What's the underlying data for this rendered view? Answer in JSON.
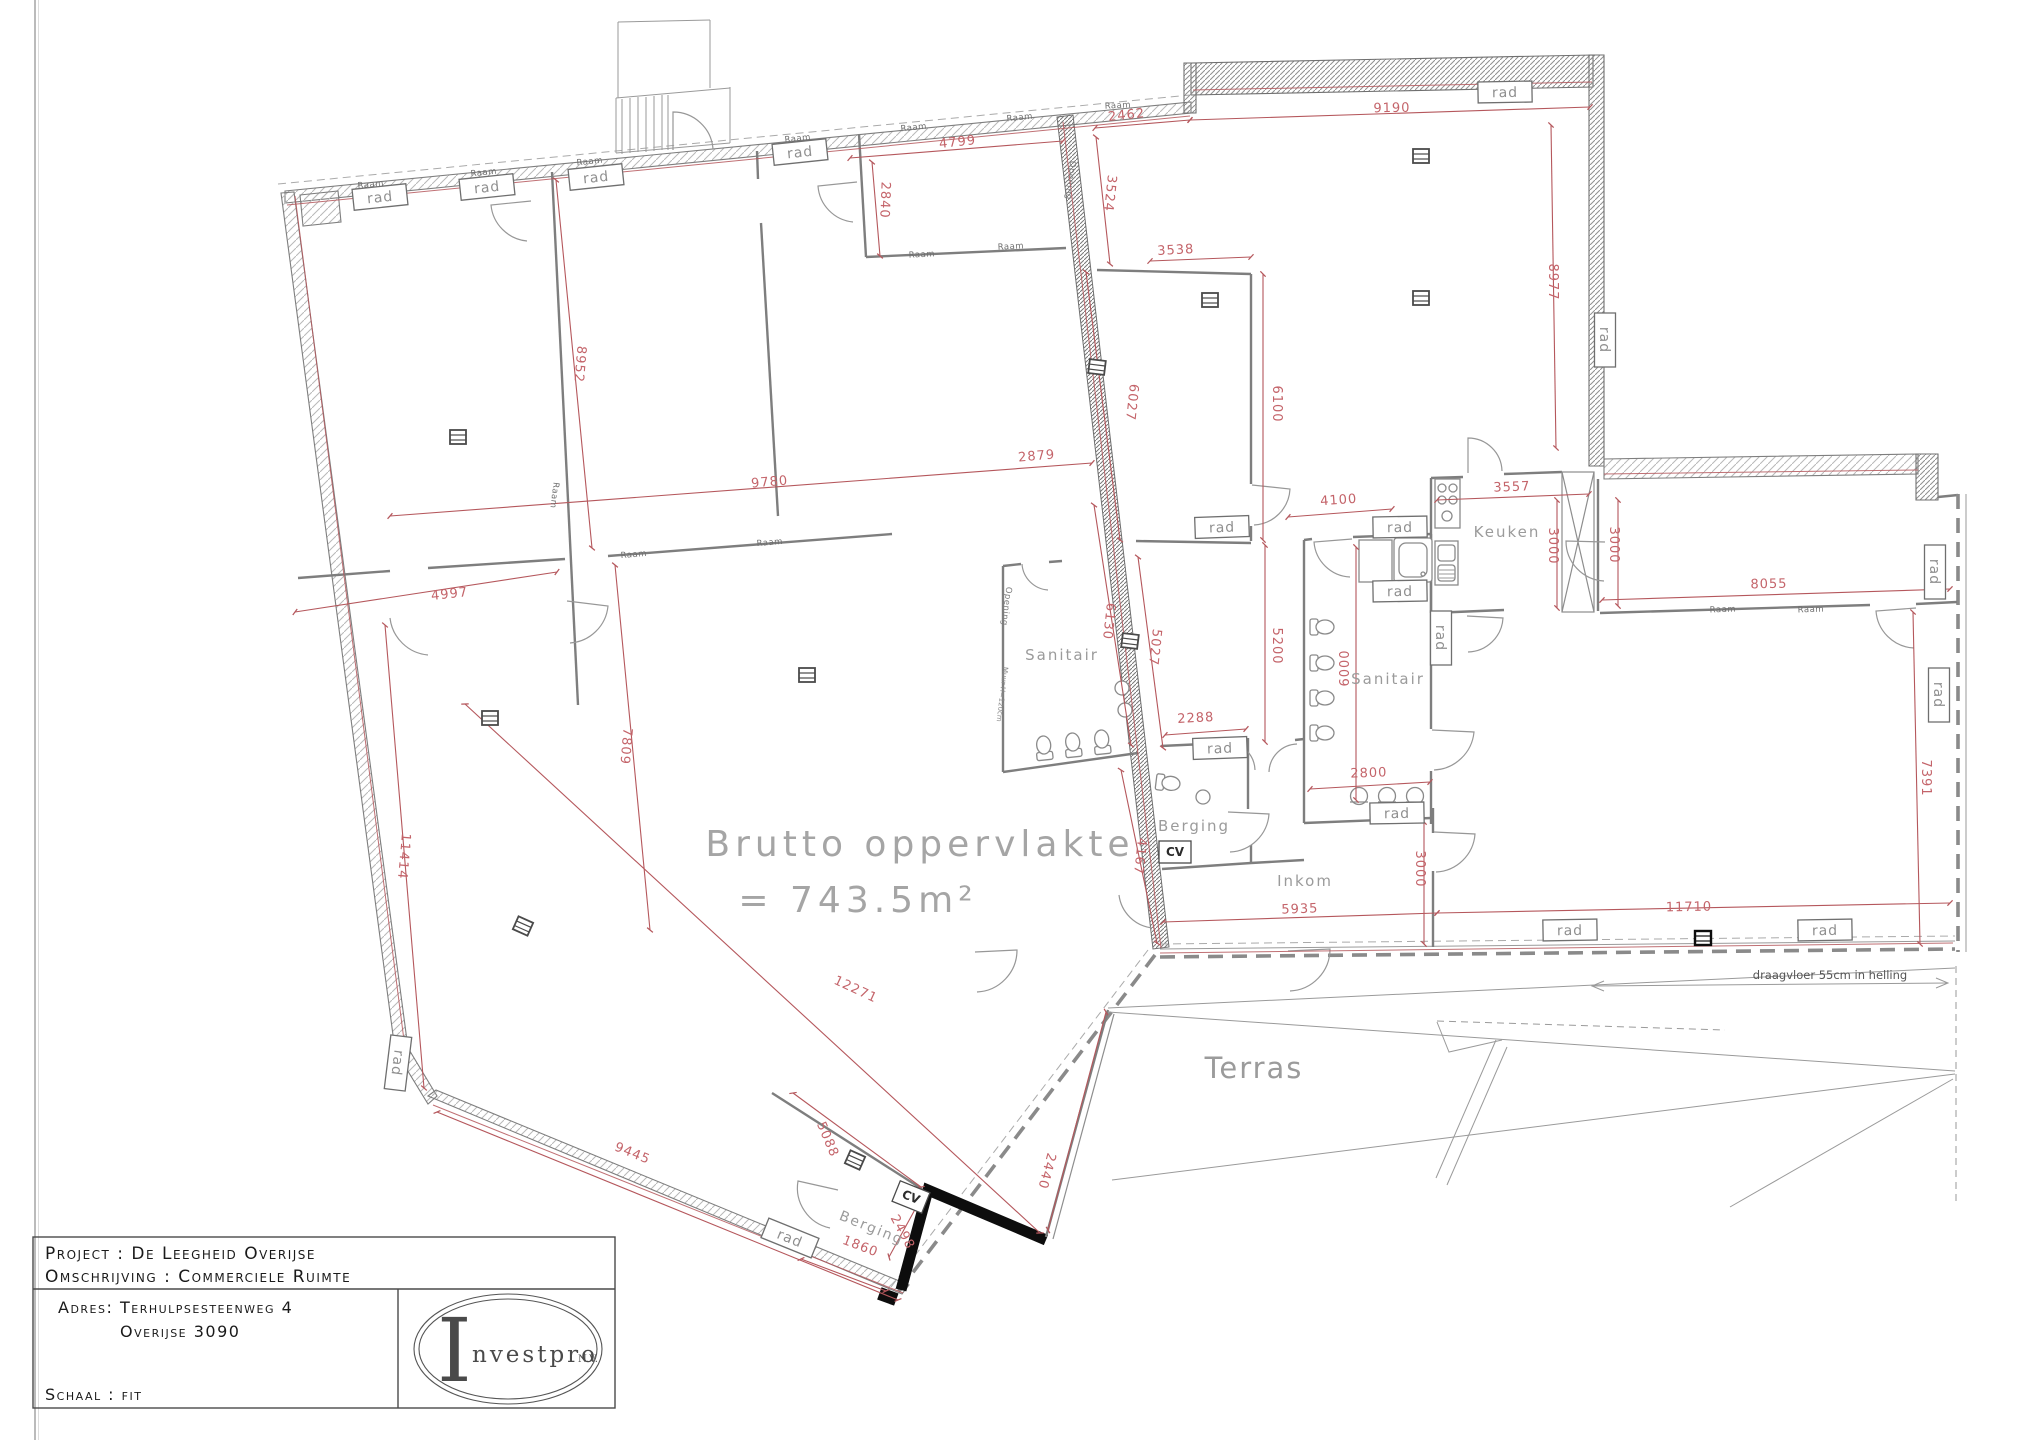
{
  "colors": {
    "dimension_text": "#c4646a",
    "dimension_line": "#b5575c",
    "label_gray": "#9b9b9b",
    "wall_gray": "#7e7e7e",
    "accent_black": "#0d0d0d"
  },
  "title_block": {
    "project_label": "Project : De Leegheid  Overijse",
    "omschrijving_label": "Omschrijving : Commerciele Ruimte",
    "adres_line1": "Adres: Terhulpsesteenweg 4",
    "adres_line2": "Overijse 3090",
    "schaal_label": "Schaal : fit",
    "logo": {
      "initial": "I",
      "name": "nvestpro",
      "suffix": "N.V."
    }
  },
  "plan": {
    "area_label": {
      "line1": "Brutto  oppervlakte",
      "line2": "=  743.5m²"
    },
    "terras_label": "Terras",
    "ramp_note": "draagvloer  55cm  in  helling",
    "rad_label": "rad",
    "raam_label": "Raam",
    "opening_label": "Opening",
    "muur_note": "Muur H=120cm",
    "cv_label": "CV",
    "room_labels": [
      {
        "text": "Sanitair",
        "x": 1062,
        "y": 660,
        "size": 15
      },
      {
        "text": "Sanitair",
        "x": 1388,
        "y": 684,
        "size": 15
      },
      {
        "text": "Keuken",
        "x": 1507,
        "y": 537,
        "size": 15
      },
      {
        "text": "Berging",
        "x": 1194,
        "y": 831,
        "size": 15
      },
      {
        "text": "Inkom",
        "x": 1305,
        "y": 886,
        "size": 15
      },
      {
        "text": "Berging",
        "x": 870,
        "y": 1232,
        "size": 14,
        "rot": 22
      }
    ],
    "dimensions": [
      {
        "t": "2462",
        "x": 1127,
        "y": 119,
        "r": -6
      },
      {
        "t": "9190",
        "x": 1392,
        "y": 112,
        "r": -1
      },
      {
        "t": "3524",
        "x": 1106,
        "y": 193,
        "r": 96
      },
      {
        "t": "3538",
        "x": 1176,
        "y": 254,
        "r": -3
      },
      {
        "t": "8977",
        "x": 1549,
        "y": 282,
        "r": 90
      },
      {
        "t": "4799",
        "x": 958,
        "y": 146,
        "r": -6
      },
      {
        "t": "2840",
        "x": 881,
        "y": 200,
        "r": 92
      },
      {
        "t": "8952",
        "x": 576,
        "y": 364,
        "r": 95
      },
      {
        "t": "9780",
        "x": 770,
        "y": 486,
        "r": -5
      },
      {
        "t": "2879",
        "x": 1037,
        "y": 460,
        "r": -5
      },
      {
        "t": "4997",
        "x": 450,
        "y": 598,
        "r": -6
      },
      {
        "t": "7809",
        "x": 622,
        "y": 746,
        "r": 95
      },
      {
        "t": "11414",
        "x": 400,
        "y": 856,
        "r": 95
      },
      {
        "t": "6027",
        "x": 1128,
        "y": 402,
        "r": 96
      },
      {
        "t": "6100",
        "x": 1273,
        "y": 404,
        "r": 90
      },
      {
        "t": "6130",
        "x": 1105,
        "y": 621,
        "r": 96
      },
      {
        "t": "5027",
        "x": 1151,
        "y": 647,
        "r": 96
      },
      {
        "t": "5200",
        "x": 1273,
        "y": 646,
        "r": 90
      },
      {
        "t": "2288",
        "x": 1196,
        "y": 722,
        "r": -3
      },
      {
        "t": "4167",
        "x": 1136,
        "y": 856,
        "r": 96
      },
      {
        "t": "4100",
        "x": 1339,
        "y": 504,
        "r": -4
      },
      {
        "t": "3557",
        "x": 1512,
        "y": 491,
        "r": -2
      },
      {
        "t": "3000",
        "x": 1549,
        "y": 546,
        "r": 90
      },
      {
        "t": "3000",
        "x": 1610,
        "y": 545,
        "r": 90
      },
      {
        "t": "8055",
        "x": 1769,
        "y": 588,
        "r": -1
      },
      {
        "t": "6000",
        "x": 1349,
        "y": 668,
        "r": -90
      },
      {
        "t": "2800",
        "x": 1369,
        "y": 777,
        "r": -2
      },
      {
        "t": "7391",
        "x": 1922,
        "y": 778,
        "r": 90
      },
      {
        "t": "3000",
        "x": 1416,
        "y": 869,
        "r": 90
      },
      {
        "t": "5935",
        "x": 1300,
        "y": 913,
        "r": -2
      },
      {
        "t": "11710",
        "x": 1689,
        "y": 911,
        "r": -1
      },
      {
        "t": "12271",
        "x": 854,
        "y": 993,
        "r": 25
      },
      {
        "t": "9445",
        "x": 631,
        "y": 1157,
        "r": 22
      },
      {
        "t": "5088",
        "x": 824,
        "y": 1141,
        "r": 67
      },
      {
        "t": "2440",
        "x": 1043,
        "y": 1170,
        "r": 105
      },
      {
        "t": "1860",
        "x": 859,
        "y": 1250,
        "r": 21
      },
      {
        "t": "2498",
        "x": 899,
        "y": 1234,
        "r": 62
      }
    ],
    "rad_boxes": [
      {
        "x": 380,
        "y": 197,
        "r": -6
      },
      {
        "x": 487,
        "y": 187,
        "r": -6
      },
      {
        "x": 596,
        "y": 177,
        "r": -6
      },
      {
        "x": 800,
        "y": 152,
        "r": -6
      },
      {
        "x": 1505,
        "y": 92,
        "r": -1
      },
      {
        "x": 1605,
        "y": 340,
        "r": 90
      },
      {
        "x": 1400,
        "y": 527,
        "r": -1
      },
      {
        "x": 1400,
        "y": 591,
        "r": -1
      },
      {
        "x": 1441,
        "y": 638,
        "r": 90
      },
      {
        "x": 1222,
        "y": 527,
        "r": -2
      },
      {
        "x": 1220,
        "y": 748,
        "r": -2
      },
      {
        "x": 1397,
        "y": 813,
        "r": -1
      },
      {
        "x": 1935,
        "y": 572,
        "r": 90
      },
      {
        "x": 1939,
        "y": 695,
        "r": 90
      },
      {
        "x": 1825,
        "y": 930,
        "r": -1
      },
      {
        "x": 1570,
        "y": 930,
        "r": -1
      },
      {
        "x": 398,
        "y": 1063,
        "r": 97
      },
      {
        "x": 790,
        "y": 1238,
        "r": 22
      }
    ],
    "raam_marks": [
      {
        "x": 371,
        "y": 187,
        "r": -6
      },
      {
        "x": 484,
        "y": 175,
        "r": -6
      },
      {
        "x": 590,
        "y": 164,
        "r": -6
      },
      {
        "x": 798,
        "y": 141,
        "r": -6
      },
      {
        "x": 914,
        "y": 130,
        "r": -6
      },
      {
        "x": 1020,
        "y": 120,
        "r": -6
      },
      {
        "x": 1118,
        "y": 108,
        "r": -3
      },
      {
        "x": 552,
        "y": 495,
        "r": 97
      },
      {
        "x": 634,
        "y": 557,
        "r": -5
      },
      {
        "x": 770,
        "y": 545,
        "r": -5
      },
      {
        "x": 922,
        "y": 257,
        "r": -3
      },
      {
        "x": 1011,
        "y": 249,
        "r": -3
      },
      {
        "x": 1723,
        "y": 612,
        "r": -2
      },
      {
        "x": 1811,
        "y": 612,
        "r": -2
      }
    ],
    "opening_marks": [
      {
        "x": 1068,
        "y": 180,
        "r": 97
      },
      {
        "x": 1004,
        "y": 606,
        "r": 97
      }
    ],
    "muur_marks": [
      {
        "x": 1000,
        "y": 694,
        "r": 97
      }
    ],
    "cv_boxes": [
      {
        "x": 1175,
        "y": 852,
        "r": 0
      },
      {
        "x": 911,
        "y": 1197,
        "r": 22
      }
    ],
    "columns": [
      {
        "x": 458,
        "y": 437,
        "r": 0
      },
      {
        "x": 490,
        "y": 718,
        "r": 0
      },
      {
        "x": 807,
        "y": 675,
        "r": 0
      },
      {
        "x": 1210,
        "y": 300,
        "r": 0
      },
      {
        "x": 1421,
        "y": 156,
        "r": 0
      },
      {
        "x": 1421,
        "y": 298,
        "r": 0
      },
      {
        "x": 1097,
        "y": 367,
        "r": 7
      },
      {
        "x": 1130,
        "y": 641,
        "r": 7
      },
      {
        "x": 855,
        "y": 1160,
        "r": 24
      },
      {
        "x": 523,
        "y": 926,
        "r": 24
      }
    ],
    "beams": [
      {
        "x": 1703,
        "y": 938,
        "r": 0
      }
    ]
  }
}
